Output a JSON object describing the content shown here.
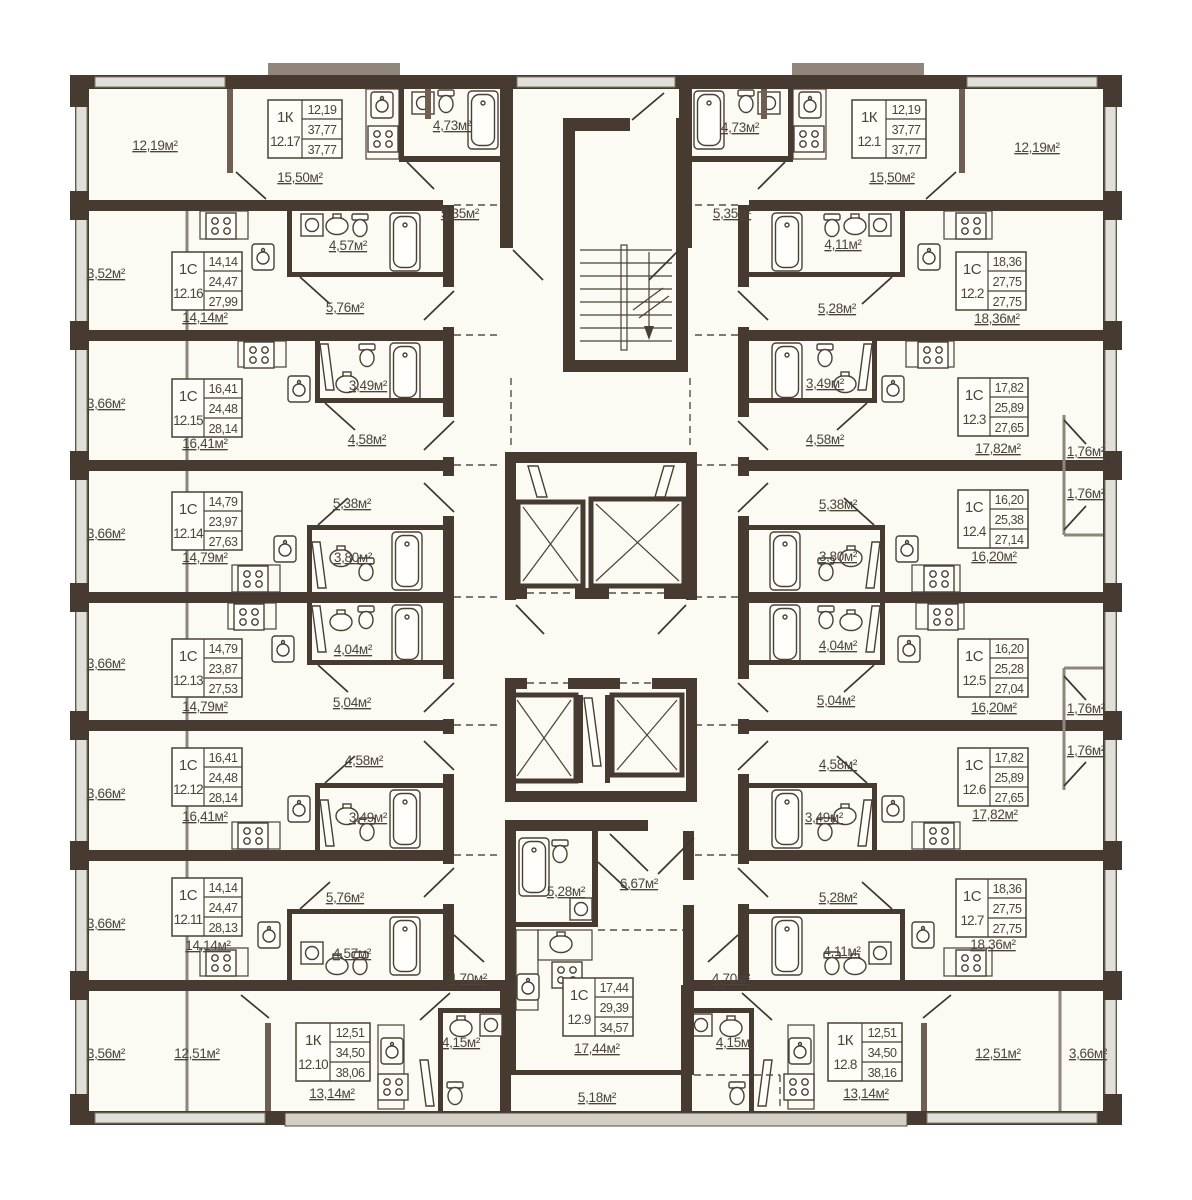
{
  "title": "floor-plan-level-12",
  "colors": {
    "wall_dark": "#473a30",
    "wall_medium": "#6f5f52",
    "room_fill": "#fbfaf3",
    "glazing": "#e0e0d8",
    "text": "#4c443b",
    "background": "#ffffff"
  },
  "apartments": [
    {
      "unit": "12.17",
      "type": "1К",
      "values": [
        "12,19",
        "37,77",
        "37,77"
      ]
    },
    {
      "unit": "12.16",
      "type": "1С",
      "values": [
        "14,14",
        "24,47",
        "27,99"
      ]
    },
    {
      "unit": "12.15",
      "type": "1С",
      "values": [
        "16,41",
        "24,48",
        "28,14"
      ]
    },
    {
      "unit": "12.14",
      "type": "1С",
      "values": [
        "14,79",
        "23,97",
        "27,63"
      ]
    },
    {
      "unit": "12.13",
      "type": "1С",
      "values": [
        "14,79",
        "23,87",
        "27,53"
      ]
    },
    {
      "unit": "12.12",
      "type": "1С",
      "values": [
        "16,41",
        "24,48",
        "28,14"
      ]
    },
    {
      "unit": "12.11",
      "type": "1С",
      "values": [
        "14,14",
        "24,47",
        "28,13"
      ]
    },
    {
      "unit": "12.10",
      "type": "1К",
      "values": [
        "12,51",
        "34,50",
        "38,06"
      ]
    },
    {
      "unit": "12.9",
      "type": "1С",
      "values": [
        "17,44",
        "29,39",
        "34,57"
      ]
    },
    {
      "unit": "12.1",
      "type": "1К",
      "values": [
        "12,19",
        "37,77",
        "37,77"
      ]
    },
    {
      "unit": "12.2",
      "type": "1С",
      "values": [
        "18,36",
        "27,75",
        "27,75"
      ]
    },
    {
      "unit": "12.3",
      "type": "1С",
      "values": [
        "17,82",
        "25,89",
        "27,65"
      ]
    },
    {
      "unit": "12.4",
      "type": "1С",
      "values": [
        "16,20",
        "25,38",
        "27,14"
      ]
    },
    {
      "unit": "12.5",
      "type": "1С",
      "values": [
        "16,20",
        "25,28",
        "27,04"
      ]
    },
    {
      "unit": "12.6",
      "type": "1С",
      "values": [
        "17,82",
        "25,89",
        "27,65"
      ]
    },
    {
      "unit": "12.7",
      "type": "1С",
      "values": [
        "18,36",
        "27,75",
        "27,75"
      ]
    },
    {
      "unit": "12.8",
      "type": "1К",
      "values": [
        "12,51",
        "34,50",
        "38,16"
      ]
    }
  ],
  "labels": [
    "12,19м²",
    "15,50м²",
    "4,73м²",
    "5,35м²",
    "3,52м²",
    "14,14м²",
    "4,57м²",
    "5,76м²",
    "3,66м²",
    "16,41м²",
    "3,49м²",
    "4,58м²",
    "3,66м²",
    "14,79м²",
    "5,38м²",
    "3,80м²",
    "3,66м²",
    "14,79м²",
    "4,04м²",
    "5,04м²",
    "3,66м²",
    "16,41м²",
    "4,58м²",
    "3,49м²",
    "3,66м²",
    "14,14м²",
    "5,76м²",
    "4,57м²",
    "3,56м²",
    "12,51м²",
    "13,14м²",
    "4,15м²",
    "4,70м²",
    "5,28м²",
    "6,67м²",
    "17,44м²",
    "5,18м²",
    "4,70м²",
    "4,15м²",
    "5,35м²",
    "4,73м²",
    "15,50м²",
    "12,19м²",
    "4,11м²",
    "5,28м²",
    "18,36м²",
    "3,49м²",
    "4,58м²",
    "17,82м²",
    "1,76м²",
    "5,38м²",
    "3,80м²",
    "16,20м²",
    "1,76м²",
    "4,04м²",
    "5,04м²",
    "16,20м²",
    "1,76м²",
    "4,58м²",
    "3,49м²",
    "17,82м²",
    "1,76м²",
    "5,28м²",
    "4,11м²",
    "18,36м²",
    "13,14м²",
    "12,51м²",
    "3,66м²"
  ]
}
